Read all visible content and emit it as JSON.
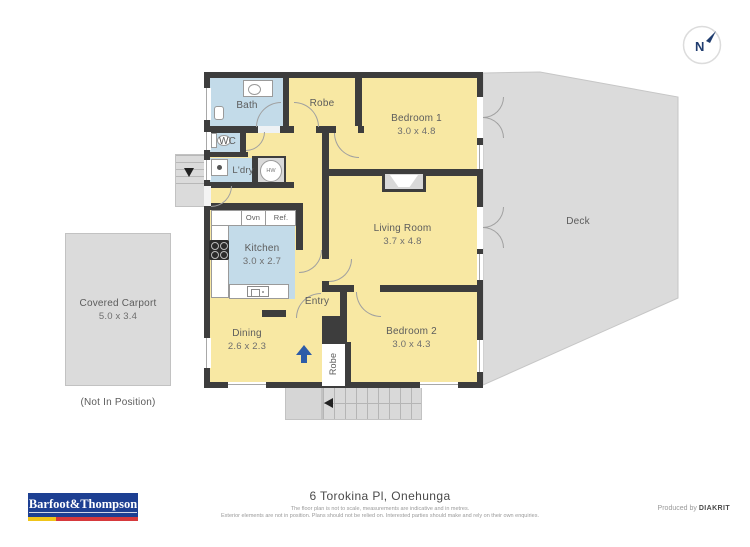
{
  "page": {
    "address": "6 Torokina Pl, Onehunga",
    "disclaimer_line1": "The floor plan is not to scale, measurements are indicative and in metres.",
    "disclaimer_line2": "Exterior elements are not in position. Plans should not be relied on. Interested parties should make and rely on their own enquiries.",
    "produced_by": "Produced by",
    "producer": "DIAKRIT",
    "brand": "Barfoot&Thompson"
  },
  "compass": {
    "label": "N"
  },
  "rooms": {
    "bath": {
      "label": "Bath"
    },
    "robe_top": {
      "label": "Robe"
    },
    "bedroom1": {
      "label": "Bedroom 1",
      "dims": "3.0 x 4.8"
    },
    "wc": {
      "label": "WC"
    },
    "laundry": {
      "label": "L'dry"
    },
    "hot_water": {
      "label": "HW"
    },
    "living": {
      "label": "Living Room",
      "dims": "3.7 x 4.8"
    },
    "deck": {
      "label": "Deck"
    },
    "kitchen": {
      "label": "Kitchen",
      "dims": "3.0 x 2.7"
    },
    "oven": {
      "label": "Ovn"
    },
    "fridge": {
      "label": "Ref."
    },
    "entry": {
      "label": "Entry"
    },
    "dining": {
      "label": "Dining",
      "dims": "2.6 x 2.3"
    },
    "bedroom2": {
      "label": "Bedroom 2",
      "dims": "3.0 x 4.3"
    },
    "robe_bottom": {
      "label": "Robe"
    },
    "carport": {
      "label": "Covered Carport",
      "dims": "5.0 x 3.4",
      "note": "(Not In Position)"
    }
  },
  "colors": {
    "room_yellow": "#f8e8a3",
    "wet_area_blue": "#c3dbe9",
    "wall": "#3d3d3d",
    "outdoor_gray": "#dbdbdb",
    "accent_navy": "#1d3f92",
    "arrow_blue": "#2d5ca8",
    "logo_yellow": "#f0c419",
    "logo_red": "#d6393c"
  }
}
